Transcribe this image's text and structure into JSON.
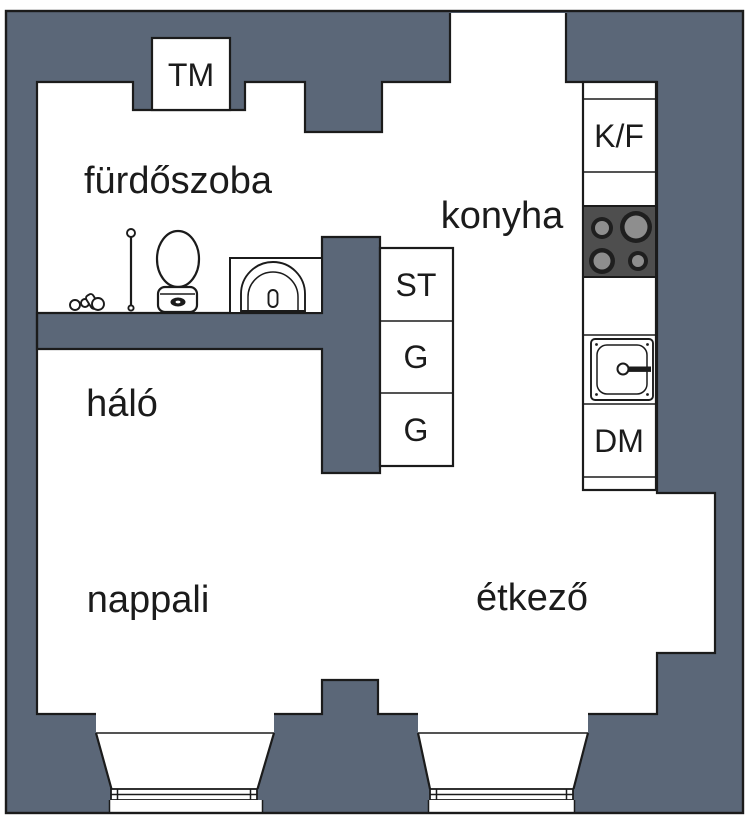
{
  "title": "apartment floor plan",
  "colors": {
    "wall": "#5b6778",
    "outline": "#1b1b1b",
    "floor": "#ffffff",
    "cooktop_panel": "#4e4e4e",
    "burner_ring": "#1f1f1f",
    "burner_center": "#8e8e8e",
    "label_text": "#1b1b1b"
  },
  "room_labels": {
    "bathroom": "fürdőszoba",
    "kitchen": "konyha",
    "bedroom": "háló",
    "living_room": "nappali",
    "dining_room": "étkező"
  },
  "appliance_labels": {
    "tm": "TM",
    "kf": "K/F",
    "st": "ST",
    "g1": "G",
    "g2": "G",
    "dm": "DM"
  },
  "fixtures": {
    "bathroom": [
      "toilet-icon",
      "corner-washbasin-icon",
      "toilet-brush-icon",
      "small-objects-icon"
    ],
    "kitchen": [
      "cooktop-icon",
      "kitchen-sink-icon"
    ],
    "windows": [
      "window-bay-left",
      "window-bay-right"
    ]
  }
}
